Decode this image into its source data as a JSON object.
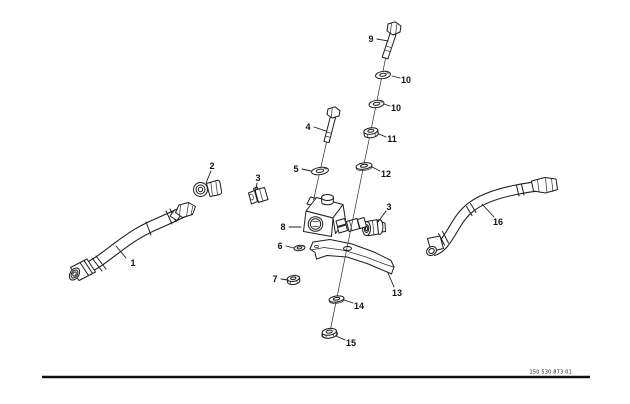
{
  "figure": {
    "type": "exploded-parts-diagram",
    "background": "#ffffff",
    "ink": "#1c1c1c",
    "part_number": "150 530 873 01",
    "callouts": {
      "c1": "1",
      "c2": "2",
      "c3a": "3",
      "c3b": "3",
      "c4": "4",
      "c5": "5",
      "c6": "6",
      "c7": "7",
      "c8": "8",
      "c9": "9",
      "c10a": "10",
      "c10b": "10",
      "c11": "11",
      "c12": "12",
      "c13": "13",
      "c14": "14",
      "c15": "15",
      "c16": "16"
    }
  }
}
